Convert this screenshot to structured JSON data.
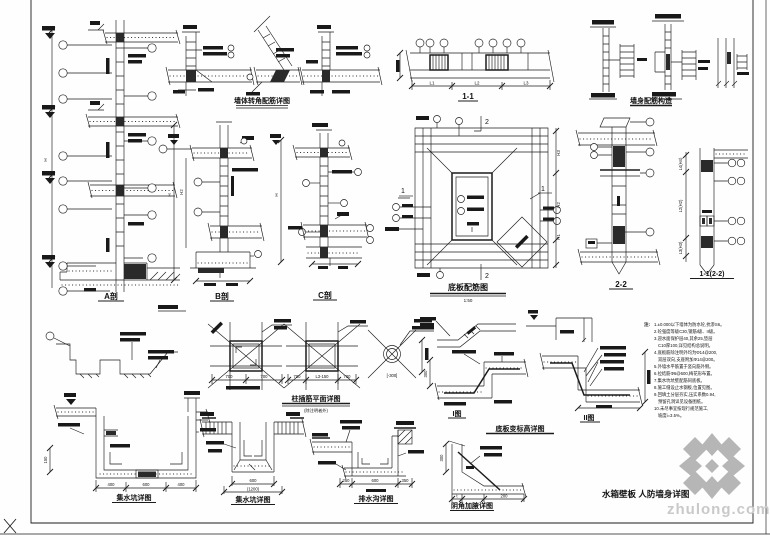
{
  "labels": {
    "section_a": "A剖",
    "section_b": "B剖",
    "section_c": "C剖",
    "sec_11": "1-1",
    "sec_22": "2-2",
    "sec_1122": "1-1(2-2)",
    "mark_1": "1",
    "mark_2": "2",
    "dim_h": "H",
    "dim_h1": "H1",
    "dim_h2": "H2",
    "dim_h3": "H3",
    "dim_l1": "L1",
    "dim_l2": "L2",
    "dim_l3": "L3",
    "dim_l4h4": "L4(H4)",
    "dim_l2h2": "L2(H2)",
    "dim_l3h3": "L3(H3)",
    "roman_1": "I图",
    "roman_2": "II图"
  },
  "titles": {
    "corner_group": "墙体转角配筋详图",
    "wall_group": "墙身配筋构造",
    "plan": "底板配筋图",
    "plan_scale": "1:50",
    "insert_group": "柱插筋平面详图",
    "insert_sub": "(除注明者外)",
    "pit_left": "集水坑详图",
    "pit_mid": "集水坑详图",
    "pit_right": "排水沟详图",
    "step_group": "底板变标高详图",
    "haunch": "阴角加腋详图",
    "footer": "水箱壁板 人防墙身详图"
  },
  "dims": {
    "p1_a": "700",
    "p1_b": "700",
    "p2_a": "700",
    "p2_b": "L3-150",
    "p2_c": "700",
    "p3": "[-300]",
    "pit1_a": "400",
    "pit1_b": "600",
    "pit1_c": "400",
    "pit2_a": "600",
    "pit2_b": "(1200)",
    "pit3_a": "250",
    "pit3_b": "600",
    "pit3_c": "350",
    "haunch_a": "300",
    "haunch_b": "200",
    "haunch_t": "t",
    "dim_150": "150",
    "step_300": "300"
  },
  "notes": {
    "heading": "注:",
    "lines": [
      "1.±0.000以下墙体为防水砼,抗渗S6。",
      "2.砼强度等级C30,钢筋I级、II级。",
      "3.迎水面保护层40,其余25,垫层",
      "C10厚100,详见结构总说明。",
      "4.底板筋除注明外均为Φ14@200,",
      "双层双向,支座附加Φ14@200。",
      "5.外墙水平筋置于竖向筋外侧。",
      "6.拉结筋Φ6@600,梅花形布置。",
      "7.集水坑坑壁配筋同底板。",
      "8.施工缝设止水钢板,位置见图。",
      "9.回填土分层夯实,压实系数0.94,",
      "预留孔洞详见设备图纸。",
      "10.未尽事宜按现行规范施工,",
      "坡度i=3.5%。"
    ]
  },
  "watermark": {
    "text": "zhulong.com"
  }
}
